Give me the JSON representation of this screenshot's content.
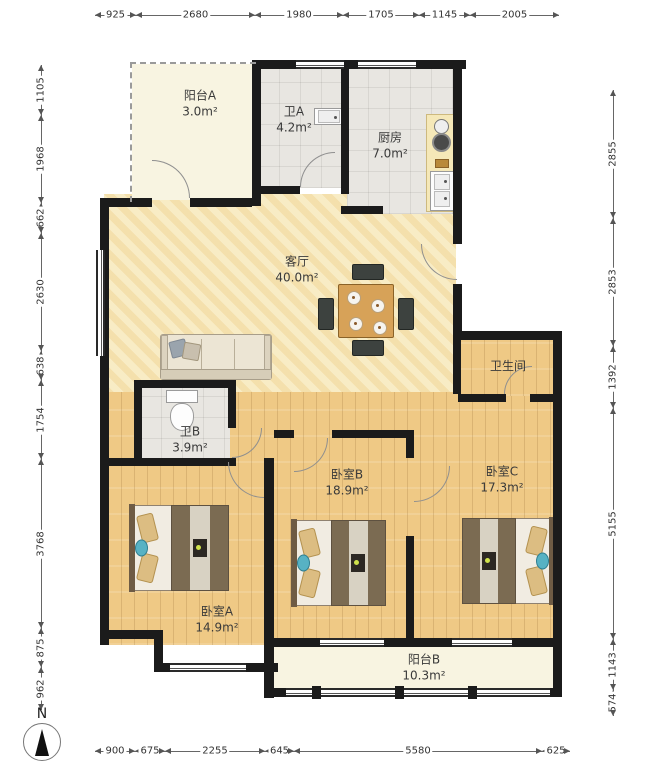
{
  "dimensions": {
    "top": [
      "925",
      "2680",
      "1980",
      "1705",
      "1145",
      "2005"
    ],
    "left": [
      "1105",
      "1968",
      "662",
      "2630",
      "638",
      "1754",
      "3768",
      "875",
      "962"
    ],
    "right": [
      "2855",
      "2853",
      "1392",
      "5155",
      "1143",
      "574"
    ],
    "bottom": [
      "900",
      "675",
      "2255",
      "645",
      "5580",
      "625"
    ]
  },
  "rooms": [
    {
      "name": "阳台A",
      "area": "3.0m²"
    },
    {
      "name": "卫A",
      "area": "4.2m²"
    },
    {
      "name": "厨房",
      "area": "7.0m²"
    },
    {
      "name": "客厅",
      "area": "40.0m²"
    },
    {
      "name": "卫生间",
      "area": ""
    },
    {
      "name": "卫B",
      "area": "3.9m²"
    },
    {
      "name": "卧室B",
      "area": "18.9m²"
    },
    {
      "name": "卧室C",
      "area": "17.3m²"
    },
    {
      "name": "卧室A",
      "area": "14.9m²"
    },
    {
      "name": "阳台B",
      "area": "10.3m²"
    }
  ],
  "compass": {
    "label": "N"
  },
  "colors": {
    "wall": "#1b1b1b",
    "wood": "#efc985",
    "living": "#f8ecc5",
    "tile": "#e8e6e1",
    "balcony": "#f8f4e1",
    "table": "#d7a258",
    "accent_teal": "#57b2c4"
  }
}
